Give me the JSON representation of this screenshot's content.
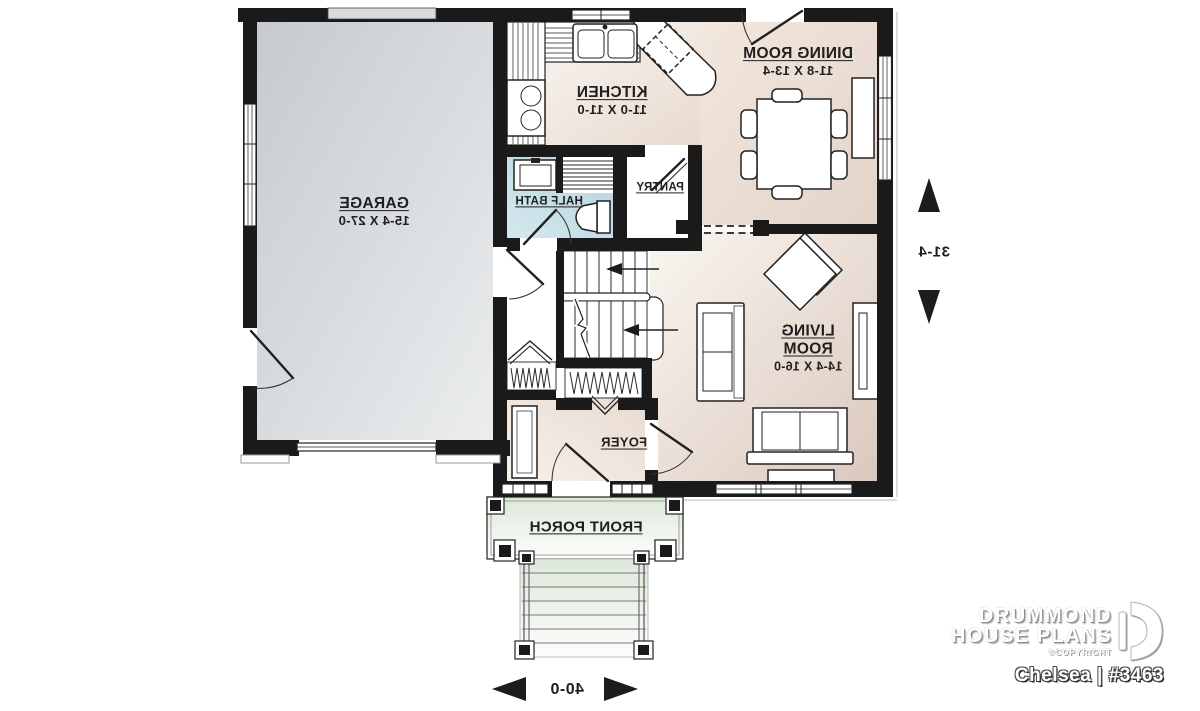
{
  "branding": {
    "company_line1": "DRUMMOND",
    "company_line2": "HOUSE PLANS",
    "copyright_note": "©COPYRIGHT",
    "plan_name": "Chelsea | #3463"
  },
  "rooms": {
    "garage": {
      "label": "GARAGE",
      "dims": "15-4 X 27-0"
    },
    "kitchen": {
      "label": "KITCHEN",
      "dims": "11-0 X 11-0"
    },
    "dining_room": {
      "label": "DINING ROOM",
      "dims": "11-8 X 13-4"
    },
    "living_room": {
      "label": "LIVING ROOM",
      "dims": "14-4 X 16-0"
    },
    "half_bath": {
      "label": "HALF BATH"
    },
    "pantry": {
      "label": "PANTRY"
    },
    "foyer": {
      "label": "FOYER"
    },
    "front_porch": {
      "label": "FRONT PORCH"
    }
  },
  "dimensions": {
    "overall_width": "40-0",
    "overall_depth": "31-4"
  },
  "colors": {
    "wall": "#1a1a1a",
    "garage_floor": "#ced2d6",
    "wood_floor": "#e9dcd2",
    "bath_floor": "#bcd9e2",
    "porch_floor": "#dfe9dd",
    "label_text": "#1f1f1f"
  }
}
